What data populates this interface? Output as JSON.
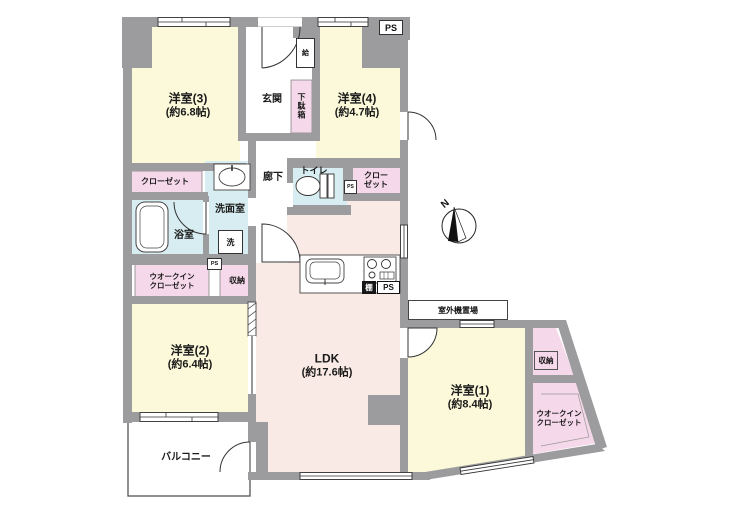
{
  "rooms": {
    "r3": {
      "name": "洋室(3)",
      "size": "(約6.8帖)"
    },
    "r4": {
      "name": "洋室(4)",
      "size": "(約4.7帖)"
    },
    "r2": {
      "name": "洋室(2)",
      "size": "(約6.4帖)"
    },
    "r1": {
      "name": "洋室(1)",
      "size": "(約8.4帖)"
    },
    "ldk": {
      "name": "LDK",
      "size": "(約17.6帖)"
    }
  },
  "labels": {
    "entrance": "玄関",
    "shoe_cabinet": "下駄箱",
    "water_heater": "給",
    "corridor": "廊下",
    "toilet": "トイレ",
    "closet": "クローゼット",
    "closet_line1": "クロー",
    "closet_line2": "ゼット",
    "washroom": "洗面室",
    "bathroom": "浴室",
    "washer": "洗",
    "walkin_line1": "ウオークイン",
    "walkin_line2": "クローゼット",
    "storage": "収納",
    "balcony": "バルコニー",
    "outdoor_unit": "室外機置場",
    "shelf": "棚",
    "pipe_space": "PS",
    "compass_north": "N"
  },
  "colors": {
    "wall": "#9c9c9e",
    "room-yellow": "#fbf9d9",
    "ldk-pink": "#faeae5",
    "closet-pink": "#f5d8e9",
    "water-cyan": "#d8edf1",
    "line": "#333333"
  }
}
